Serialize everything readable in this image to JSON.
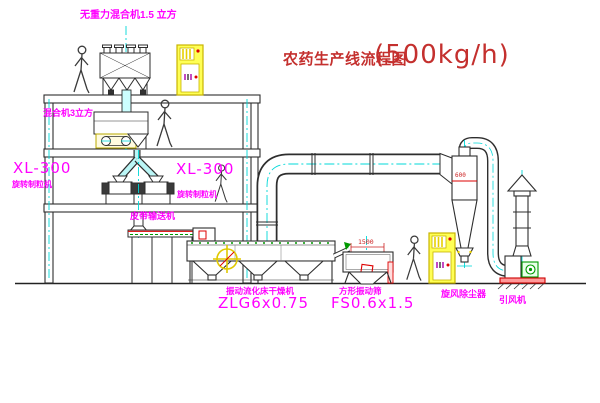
{
  "title": {
    "name": "农药生产线流程图",
    "capacity": "(500kg/h)"
  },
  "equipment": {
    "top_mixer": {
      "label": "无重力混合机1.5 立方"
    },
    "mid_mixer": {
      "label": "混合机3立方"
    },
    "granulator_left": {
      "model": "XL-300",
      "label": "旋转制粒机"
    },
    "granulator_right": {
      "model": "XL-300",
      "label": "旋转制粒机"
    },
    "belt_conveyor": {
      "label": "皮带输送机"
    },
    "fluid_bed_dryer": {
      "label": "振动流化床干燥机",
      "model": "ZLG6x0.75"
    },
    "square_sieve": {
      "label": "方形振动筛",
      "model": "FS0.6x1.5"
    },
    "cyclone": {
      "label": "旋风除尘器",
      "dimension": "600"
    },
    "induced_draft_fan": {
      "label": "引风机"
    }
  },
  "dimensions": {
    "sieve_width": "1500"
  },
  "colors": {
    "label_magenta": "#ff00ff",
    "title_red": "#c4302e",
    "dimension_red": "#cc2222",
    "centerline_cyan": "#00d8d8",
    "cabinet_yellow": "#ffff55",
    "outline_dark": "#2e2e2e",
    "accent_green": "#009900",
    "accent_red": "#dd0000"
  }
}
